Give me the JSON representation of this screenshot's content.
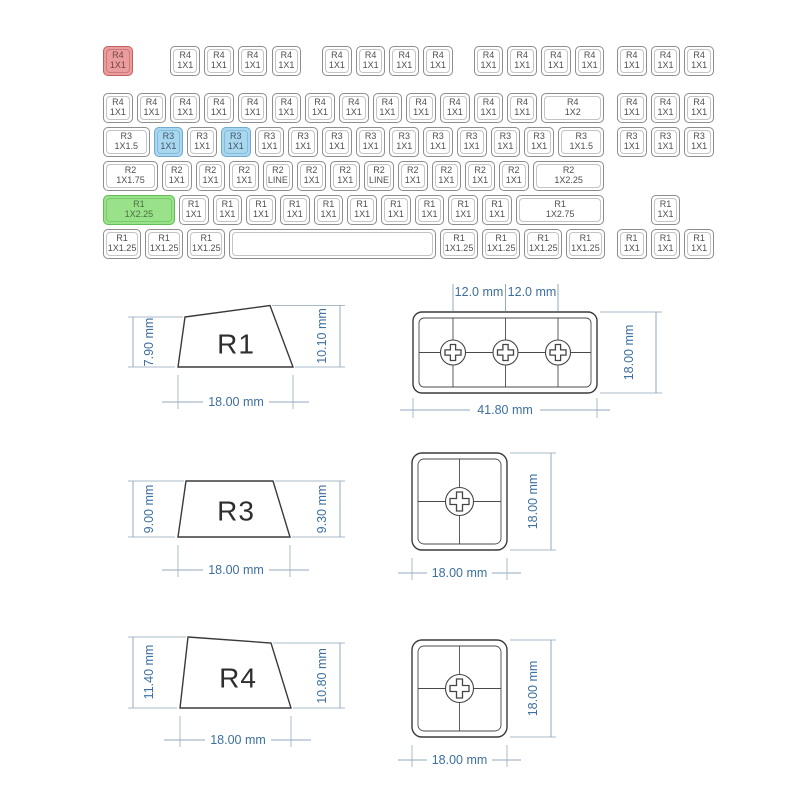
{
  "colors": {
    "background": "#ffffff",
    "red_key_fill": "#eb9c9c",
    "red_key_border": "#bf5f5f",
    "blue_key_fill": "#a9d7ef",
    "blue_key_border": "#6fa9cf",
    "green_key_fill": "#99e289",
    "green_key_border": "#63bb58",
    "key_border": "#8d8d8d",
    "key_inner_border": "#c4c4c4",
    "key_text": "#4f4f4f",
    "dimension_text": "#3d6f9f",
    "outline": "#3a3a3a"
  },
  "keyboard": {
    "origin_x": 103,
    "unit": 33.7,
    "key_height": 30,
    "rows": [
      {
        "profile": "R4",
        "y": 46,
        "keys": [
          {
            "x": 0,
            "size": "1X1",
            "color": "red"
          },
          {
            "x": 2,
            "size": "1X1"
          },
          {
            "x": 3,
            "size": "1X1"
          },
          {
            "x": 4,
            "size": "1X1"
          },
          {
            "x": 5,
            "size": "1X1"
          },
          {
            "x": 6.5,
            "size": "1X1"
          },
          {
            "x": 7.5,
            "size": "1X1"
          },
          {
            "x": 8.5,
            "size": "1X1"
          },
          {
            "x": 9.5,
            "size": "1X1"
          },
          {
            "x": 11,
            "size": "1X1"
          },
          {
            "x": 12,
            "size": "1X1"
          },
          {
            "x": 13,
            "size": "1X1"
          },
          {
            "x": 14,
            "size": "1X1"
          },
          {
            "x": 15.25,
            "size": "1X1"
          },
          {
            "x": 16.25,
            "size": "1X1"
          },
          {
            "x": 17.25,
            "size": "1X1"
          }
        ]
      },
      {
        "profile": "R4",
        "y": 93,
        "keys": [
          {
            "x": 0,
            "size": "1X1"
          },
          {
            "x": 1,
            "size": "1X1"
          },
          {
            "x": 2,
            "size": "1X1"
          },
          {
            "x": 3,
            "size": "1X1"
          },
          {
            "x": 4,
            "size": "1X1"
          },
          {
            "x": 5,
            "size": "1X1"
          },
          {
            "x": 6,
            "size": "1X1"
          },
          {
            "x": 7,
            "size": "1X1"
          },
          {
            "x": 8,
            "size": "1X1"
          },
          {
            "x": 9,
            "size": "1X1"
          },
          {
            "x": 10,
            "size": "1X1"
          },
          {
            "x": 11,
            "size": "1X1"
          },
          {
            "x": 12,
            "size": "1X1"
          },
          {
            "x": 13,
            "w": 2,
            "size": "1X2"
          },
          {
            "x": 15.25,
            "size": "1X1"
          },
          {
            "x": 16.25,
            "size": "1X1"
          },
          {
            "x": 17.25,
            "size": "1X1"
          }
        ]
      },
      {
        "profile": "R3",
        "y": 127,
        "keys": [
          {
            "x": 0,
            "w": 1.5,
            "size": "1X1.5"
          },
          {
            "x": 1.5,
            "size": "1X1",
            "color": "blue"
          },
          {
            "x": 2.5,
            "size": "1X1"
          },
          {
            "x": 3.5,
            "size": "1X1",
            "color": "blue"
          },
          {
            "x": 4.5,
            "size": "1X1"
          },
          {
            "x": 5.5,
            "size": "1X1"
          },
          {
            "x": 6.5,
            "size": "1X1"
          },
          {
            "x": 7.5,
            "size": "1X1"
          },
          {
            "x": 8.5,
            "size": "1X1"
          },
          {
            "x": 9.5,
            "size": "1X1"
          },
          {
            "x": 10.5,
            "size": "1X1"
          },
          {
            "x": 11.5,
            "size": "1X1"
          },
          {
            "x": 12.5,
            "size": "1X1"
          },
          {
            "x": 13.5,
            "w": 1.5,
            "size": "1X1.5"
          },
          {
            "x": 15.25,
            "size": "1X1"
          },
          {
            "x": 16.25,
            "size": "1X1"
          },
          {
            "x": 17.25,
            "size": "1X1"
          }
        ]
      },
      {
        "profile": "R2",
        "y": 161,
        "keys": [
          {
            "x": 0,
            "w": 1.75,
            "size": "1X1.75"
          },
          {
            "x": 1.75,
            "size": "1X1"
          },
          {
            "x": 2.75,
            "size": "1X1"
          },
          {
            "x": 3.75,
            "size": "1X1"
          },
          {
            "x": 4.75,
            "size": "LINE"
          },
          {
            "x": 5.75,
            "size": "1X1"
          },
          {
            "x": 6.75,
            "size": "1X1"
          },
          {
            "x": 7.75,
            "size": "LINE"
          },
          {
            "x": 8.75,
            "size": "1X1"
          },
          {
            "x": 9.75,
            "size": "1X1"
          },
          {
            "x": 10.75,
            "size": "1X1"
          },
          {
            "x": 11.75,
            "size": "1X1"
          },
          {
            "x": 12.75,
            "w": 2.25,
            "size": "1X2.25"
          }
        ]
      },
      {
        "profile": "R1",
        "y": 195,
        "keys": [
          {
            "x": 0,
            "w": 2.25,
            "size": "1X2.25",
            "color": "green"
          },
          {
            "x": 2.25,
            "size": "1X1"
          },
          {
            "x": 3.25,
            "size": "1X1"
          },
          {
            "x": 4.25,
            "size": "1X1"
          },
          {
            "x": 5.25,
            "size": "1X1"
          },
          {
            "x": 6.25,
            "size": "1X1"
          },
          {
            "x": 7.25,
            "size": "1X1"
          },
          {
            "x": 8.25,
            "size": "1X1"
          },
          {
            "x": 9.25,
            "size": "1X1"
          },
          {
            "x": 10.25,
            "size": "1X1"
          },
          {
            "x": 11.25,
            "size": "1X1"
          },
          {
            "x": 12.25,
            "w": 2.75,
            "size": "1X2.75"
          },
          {
            "x": 16.25,
            "size": "1X1"
          }
        ]
      },
      {
        "profile": "R1",
        "y": 229,
        "keys": [
          {
            "x": 0,
            "w": 1.25,
            "size": "1X1.25"
          },
          {
            "x": 1.25,
            "w": 1.25,
            "size": "1X1.25"
          },
          {
            "x": 2.5,
            "w": 1.25,
            "size": "1X1.25"
          },
          {
            "x": 3.75,
            "w": 6.25,
            "blank": true
          },
          {
            "x": 10,
            "w": 1.25,
            "size": "1X1.25"
          },
          {
            "x": 11.25,
            "w": 1.25,
            "size": "1X1.25"
          },
          {
            "x": 12.5,
            "w": 1.25,
            "size": "1X1.25"
          },
          {
            "x": 13.75,
            "w": 1.25,
            "size": "1X1.25"
          },
          {
            "x": 15.25,
            "size": "1X1"
          },
          {
            "x": 16.25,
            "size": "1X1"
          },
          {
            "x": 17.25,
            "size": "1X1"
          }
        ]
      }
    ]
  },
  "diagrams": {
    "profiles": [
      {
        "name": "R1",
        "left": "7.90 mm",
        "right": "10.10 mm",
        "width": "18.00 mm"
      },
      {
        "name": "R3",
        "left": "9.00 mm",
        "right": "9.30 mm",
        "width": "18.00 mm"
      },
      {
        "name": "R4",
        "left": "11.40 mm",
        "right": "10.80 mm",
        "width": "18.00 mm"
      }
    ],
    "top_views": [
      {
        "top": [
          "12.0 mm",
          "12.0 mm"
        ],
        "width": "41.80 mm",
        "height": "18.00 mm",
        "stems": 3
      },
      {
        "width": "18.00 mm",
        "height": "18.00 mm",
        "stems": 1
      },
      {
        "width": "18.00 mm",
        "height": "18.00 mm",
        "stems": 1
      }
    ]
  }
}
